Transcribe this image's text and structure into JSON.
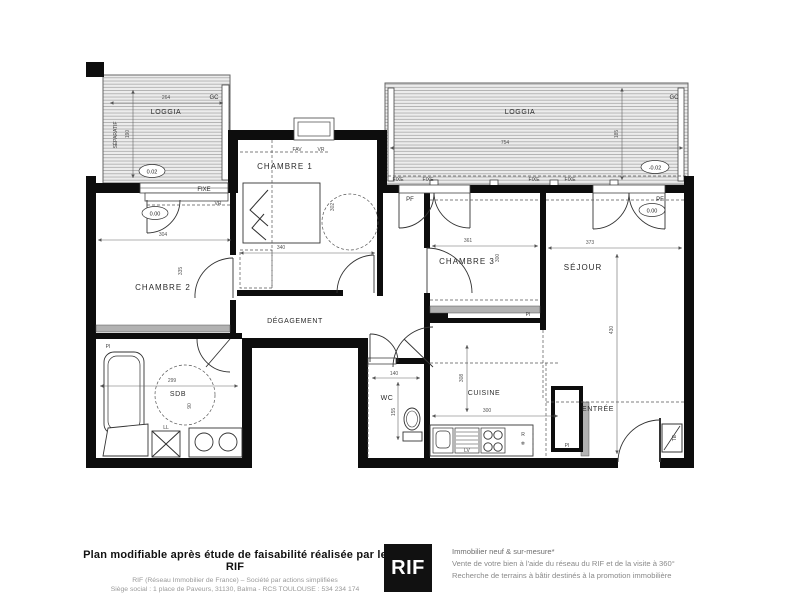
{
  "plan": {
    "colors": {
      "wall": "#0d0d0d",
      "hatch_bg": "#ececec",
      "hatch_line": "#a0a0a0",
      "placard": "#b2b2b2"
    },
    "rooms": {
      "loggia_left": "LOGGIA",
      "loggia_right": "LOGGIA",
      "chambre1": "CHAMBRE 1",
      "chambre2": "CHAMBRE 2",
      "chambre3": "CHAMBRE 3",
      "sejour": "SÉJOUR",
      "degagement": "DÉGAGEMENT",
      "sdb": "SDB",
      "wc": "WC",
      "cuisine": "CUISINE",
      "entree": "ENTRÉE"
    },
    "labels": {
      "separatif": "SÉPARATIF",
      "gc_left": "GC",
      "gc_right": "GC",
      "fixe_chambre2": "FIXE",
      "fixe_loggia_1": "FIXE",
      "fixe_loggia_2": "FIXE",
      "fixe_loggia_3": "FIXE",
      "fixe_loggia_4": "FIXE",
      "pf_chambre3": "PF",
      "pf_sejour": "PF",
      "fav_chambre1": "FAV",
      "vr_chambre1": "VR",
      "vr_chambre2": "VR",
      "pi_chambre2": "PI",
      "pi_chambre3": "PI",
      "pi_entree": "PI",
      "te_entree": "TE",
      "ll_washer": "LL",
      "lv_kitchen": "LV",
      "r_fridge": "R",
      "fridge_snowflake": "❄"
    },
    "levels": {
      "loggia_left": "0.02",
      "loggia_right": "-0.02",
      "chambre2": "0.00",
      "sejour": "0.00"
    },
    "dims": {
      "loggia_left_w": "264",
      "loggia_left_h": "190",
      "loggia_right_w": "754",
      "loggia_right_h": "185",
      "chambre1_w": "340",
      "chambre1_h": "302",
      "chambre2_w": "304",
      "chambre2_h": "335",
      "chambre3_w": "361",
      "chambre3_h": "300",
      "sejour_w": "373",
      "sejour_h": "430",
      "sdb_w": "299",
      "sdb_h": "90",
      "wc_w": "140",
      "wc_h": "155",
      "cuisine_w": "300",
      "cuisine_h": "308"
    }
  },
  "footer": {
    "left": {
      "title": "Plan modifiable après étude de faisabilité réalisée par le RIF",
      "line1": "RIF (Réseau Immobilier de France) – Société par actions simplifiées",
      "line2": "Siège social : 1 place de Paveurs, 31130, Balma - RCS TOULOUSE : 534 234 174"
    },
    "logo": "RIF",
    "right": {
      "line1": "Immobilier neuf & sur-mesure*",
      "line2": "Vente de votre bien à l'aide du réseau du RIF et de la visite à 360°",
      "line3": "Recherche de terrains à bâtir destinés à la promotion immobilière"
    }
  }
}
